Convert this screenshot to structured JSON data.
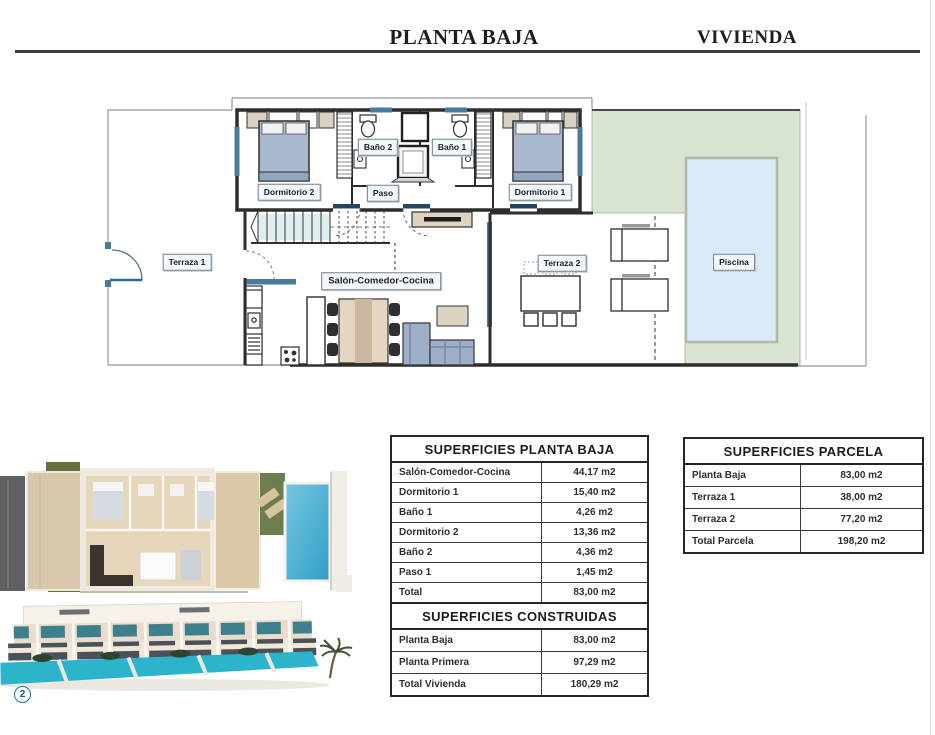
{
  "header": {
    "left_title": "PLANTA BAJA",
    "right_title": "VIVIENDA"
  },
  "floor_plan": {
    "rooms": [
      {
        "id": "terraza1",
        "label": "Terraza 1"
      },
      {
        "id": "dormitorio2",
        "label": "Dormitorio 2"
      },
      {
        "id": "bano2",
        "label": "Baño 2"
      },
      {
        "id": "bano1",
        "label": "Baño 1"
      },
      {
        "id": "paso",
        "label": "Paso"
      },
      {
        "id": "dormitorio1",
        "label": "Dormitorio 1"
      },
      {
        "id": "salon",
        "label": "Salón-Comedor-Cocina"
      },
      {
        "id": "terraza2",
        "label": "Terraza 2"
      },
      {
        "id": "piscina",
        "label": "Piscina"
      }
    ]
  },
  "tables": {
    "planta_baja": {
      "title": "SUPERFICIES PLANTA BAJA",
      "rows": [
        {
          "label": "Salón-Comedor-Cocina",
          "value": "44,17 m2"
        },
        {
          "label": "Dormitorio 1",
          "value": "15,40 m2"
        },
        {
          "label": "Baño 1",
          "value": "4,26 m2"
        },
        {
          "label": "Dormitorio 2",
          "value": "13,36 m2"
        },
        {
          "label": "Baño 2",
          "value": "4,36 m2"
        },
        {
          "label": "Paso 1",
          "value": "1,45 m2"
        },
        {
          "label": "Total",
          "value": "83,00 m2"
        }
      ]
    },
    "parcela": {
      "title": "SUPERFICIES PARCELA",
      "rows": [
        {
          "label": "Planta Baja",
          "value": "83,00 m2"
        },
        {
          "label": "Terraza 1",
          "value": "38,00 m2"
        },
        {
          "label": "Terraza 2",
          "value": "77,20 m2"
        },
        {
          "label": "Total Parcela",
          "value": "198,20 m2"
        }
      ]
    },
    "construidas": {
      "title": "SUPERFICIES CONSTRUIDAS",
      "rows": [
        {
          "label": "Planta Baja",
          "value": "83,00 m2"
        },
        {
          "label": "Planta Primera",
          "value": "97,29 m2"
        },
        {
          "label": "Total  Vivienda",
          "value": "180,29 m2"
        }
      ]
    }
  },
  "badge": {
    "number": "2"
  },
  "colors": {
    "wall": "#2e2e2e",
    "garden_green": "#d8e4cf",
    "pool_blue": "#d9e9f6",
    "window_blue": "#4a7b9d",
    "bed_blue": "#a9b8ce",
    "wood_beige": "#ded3c0",
    "render_pool": "#3fa9cf",
    "render_pool_strip": "#2cb4cd",
    "badge_teal": "#22768f"
  }
}
